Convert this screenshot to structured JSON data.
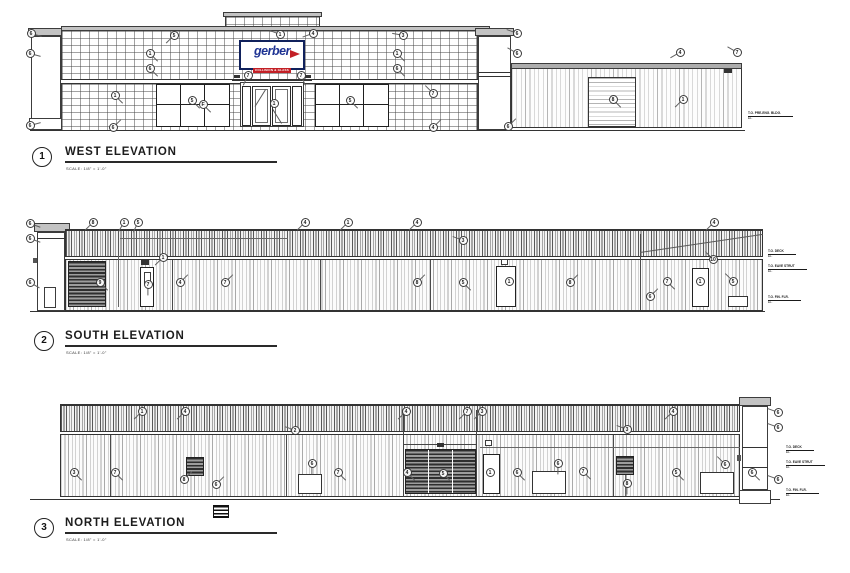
{
  "sheet": {
    "background": "#ffffff",
    "line_color": "#3c3c3c"
  },
  "sign": {
    "name": "gerber",
    "tagline": "COLLISION & GLASS",
    "blue": "#1d3293",
    "red": "#c32026"
  },
  "west": {
    "num": "1",
    "title": "WEST ELEVATION",
    "scale": "SCALE: 1/8\" = 1'-0\"",
    "callouts": [
      {
        "x": 31,
        "y": 33,
        "n": "6",
        "a": 15
      },
      {
        "x": 30,
        "y": 53,
        "n": "6",
        "a": 15
      },
      {
        "x": 30,
        "y": 125,
        "n": "6",
        "a": 345
      },
      {
        "x": 174,
        "y": 35,
        "n": "5",
        "a": 135
      },
      {
        "x": 150,
        "y": 53,
        "n": "1",
        "a": 45
      },
      {
        "x": 150,
        "y": 68,
        "n": "6",
        "a": 45
      },
      {
        "x": 115,
        "y": 95,
        "n": "1",
        "a": 45
      },
      {
        "x": 113,
        "y": 127,
        "n": "6",
        "a": 315
      },
      {
        "x": 192,
        "y": 100,
        "n": "5",
        "a": 45
      },
      {
        "x": 203,
        "y": 104,
        "n": "F",
        "a": 45
      },
      {
        "x": 248,
        "y": 75,
        "n": "7",
        "a": 115
      },
      {
        "x": 301,
        "y": 75,
        "n": "7",
        "a": 65
      },
      {
        "x": 274,
        "y": 103,
        "n": "1"
      },
      {
        "x": 280,
        "y": 34,
        "n": "1",
        "a": 200
      },
      {
        "x": 313,
        "y": 33,
        "n": "4",
        "a": 160
      },
      {
        "x": 403,
        "y": 35,
        "n": "3",
        "a": 190
      },
      {
        "x": 397,
        "y": 53,
        "n": "1",
        "a": 45
      },
      {
        "x": 397,
        "y": 68,
        "n": "6",
        "a": 45
      },
      {
        "x": 433,
        "y": 93,
        "n": "7",
        "a": 225
      },
      {
        "x": 350,
        "y": 100,
        "n": "5",
        "a": 45
      },
      {
        "x": 517,
        "y": 33,
        "n": "6",
        "a": 200
      },
      {
        "x": 517,
        "y": 53,
        "n": "6",
        "a": 210
      },
      {
        "x": 680,
        "y": 52,
        "n": "4",
        "a": 150
      },
      {
        "x": 737,
        "y": 52,
        "n": "7",
        "a": 210
      },
      {
        "x": 613,
        "y": 99,
        "n": "8",
        "a": 45
      },
      {
        "x": 683,
        "y": 99,
        "n": "1",
        "a": 135
      },
      {
        "x": 433,
        "y": 127,
        "n": "4",
        "a": 315
      },
      {
        "x": 508,
        "y": 126,
        "n": "6",
        "a": 315
      }
    ],
    "datums": [
      {
        "x": 748,
        "y": 112,
        "l1": "T.O. PRE-ENG. BLDG.",
        "l2": "EL."
      }
    ]
  },
  "south": {
    "num": "2",
    "title": "SOUTH ELEVATION",
    "scale": "SCALE: 1/8\" = 1'-0\"",
    "callouts": [
      {
        "x": 30,
        "y": 223,
        "n": "6",
        "a": 20
      },
      {
        "x": 30,
        "y": 238,
        "n": "6",
        "a": 20
      },
      {
        "x": 30,
        "y": 282,
        "n": "6",
        "a": 30
      },
      {
        "x": 93,
        "y": 222,
        "n": "8",
        "a": 135
      },
      {
        "x": 124,
        "y": 222,
        "n": "1",
        "a": 120
      },
      {
        "x": 138,
        "y": 222,
        "n": "5",
        "a": 115
      },
      {
        "x": 305,
        "y": 222,
        "n": "4",
        "a": 135
      },
      {
        "x": 348,
        "y": 222,
        "n": "1",
        "a": 135
      },
      {
        "x": 417,
        "y": 222,
        "n": "4",
        "a": 135
      },
      {
        "x": 714,
        "y": 222,
        "n": "4",
        "a": 135
      },
      {
        "x": 463,
        "y": 240,
        "n": "3",
        "a": 200
      },
      {
        "x": 163,
        "y": 257,
        "n": "1",
        "a": 135
      },
      {
        "x": 100,
        "y": 282,
        "n": "9",
        "a": 45
      },
      {
        "x": 180,
        "y": 282,
        "n": "4",
        "a": 315
      },
      {
        "x": 225,
        "y": 282,
        "n": "7",
        "a": 315
      },
      {
        "x": 148,
        "y": 284,
        "n": "7",
        "a": 90
      },
      {
        "x": 417,
        "y": 282,
        "n": "8",
        "a": 315
      },
      {
        "x": 463,
        "y": 282,
        "n": "5",
        "a": 45
      },
      {
        "x": 509,
        "y": 281,
        "n": "1"
      },
      {
        "x": 570,
        "y": 282,
        "n": "8",
        "a": 315
      },
      {
        "x": 667,
        "y": 281,
        "n": "7",
        "a": 45
      },
      {
        "x": 700,
        "y": 281,
        "n": "1"
      },
      {
        "x": 733,
        "y": 281,
        "n": "5",
        "a": 225
      },
      {
        "x": 713,
        "y": 259,
        "n": "10",
        "a": 225
      },
      {
        "x": 650,
        "y": 296,
        "n": "6",
        "a": 315
      }
    ],
    "datums": [
      {
        "x": 768,
        "y": 250,
        "l1": "T.O. DECK",
        "l2": "EL."
      },
      {
        "x": 768,
        "y": 265,
        "l1": "T.O. EAVE STRUT",
        "l2": "EL."
      },
      {
        "x": 768,
        "y": 296,
        "l1": "T.O. FIN. FLR.",
        "l2": "EL."
      }
    ]
  },
  "north": {
    "num": "3",
    "title": "NORTH ELEVATION",
    "scale": "SCALE: 1/8\" = 1'-0\"",
    "callouts": [
      {
        "x": 142,
        "y": 411,
        "n": "1",
        "a": 135
      },
      {
        "x": 185,
        "y": 411,
        "n": "4",
        "a": 135
      },
      {
        "x": 406,
        "y": 411,
        "n": "4",
        "a": 135
      },
      {
        "x": 467,
        "y": 411,
        "n": "7",
        "a": 135
      },
      {
        "x": 482,
        "y": 411,
        "n": "3",
        "a": 135
      },
      {
        "x": 673,
        "y": 411,
        "n": "4",
        "a": 135
      },
      {
        "x": 295,
        "y": 430,
        "n": "2",
        "a": 200
      },
      {
        "x": 627,
        "y": 429,
        "n": "3",
        "a": 200
      },
      {
        "x": 74,
        "y": 472,
        "n": "3",
        "a": 45
      },
      {
        "x": 115,
        "y": 472,
        "n": "7",
        "a": 45
      },
      {
        "x": 184,
        "y": 479,
        "n": "8",
        "a": 315
      },
      {
        "x": 216,
        "y": 484,
        "n": "6",
        "a": 315
      },
      {
        "x": 312,
        "y": 463,
        "n": "6",
        "a": 90
      },
      {
        "x": 338,
        "y": 472,
        "n": "7",
        "a": 45
      },
      {
        "x": 407,
        "y": 472,
        "n": "4",
        "a": 45
      },
      {
        "x": 443,
        "y": 473,
        "n": "5",
        "a": 45
      },
      {
        "x": 490,
        "y": 472,
        "n": "1"
      },
      {
        "x": 517,
        "y": 472,
        "n": "6",
        "a": 45
      },
      {
        "x": 558,
        "y": 463,
        "n": "6",
        "a": 90
      },
      {
        "x": 583,
        "y": 471,
        "n": "7",
        "a": 45
      },
      {
        "x": 627,
        "y": 483,
        "n": "8",
        "a": 90
      },
      {
        "x": 676,
        "y": 472,
        "n": "5",
        "a": 45
      },
      {
        "x": 725,
        "y": 464,
        "n": "6",
        "a": 225
      },
      {
        "x": 752,
        "y": 472,
        "n": "6",
        "a": 45
      },
      {
        "x": 778,
        "y": 412,
        "n": "6",
        "a": 200
      },
      {
        "x": 778,
        "y": 427,
        "n": "6",
        "a": 200
      },
      {
        "x": 778,
        "y": 479,
        "n": "6",
        "a": 200
      }
    ],
    "datums": [
      {
        "x": 786,
        "y": 446,
        "l1": "T.O. DECK",
        "l2": "EL."
      },
      {
        "x": 786,
        "y": 461,
        "l1": "T.O. EAVE STRUT",
        "l2": "EL."
      },
      {
        "x": 786,
        "y": 489,
        "l1": "T.O. FIN. FLR.",
        "l2": "EL."
      }
    ]
  }
}
